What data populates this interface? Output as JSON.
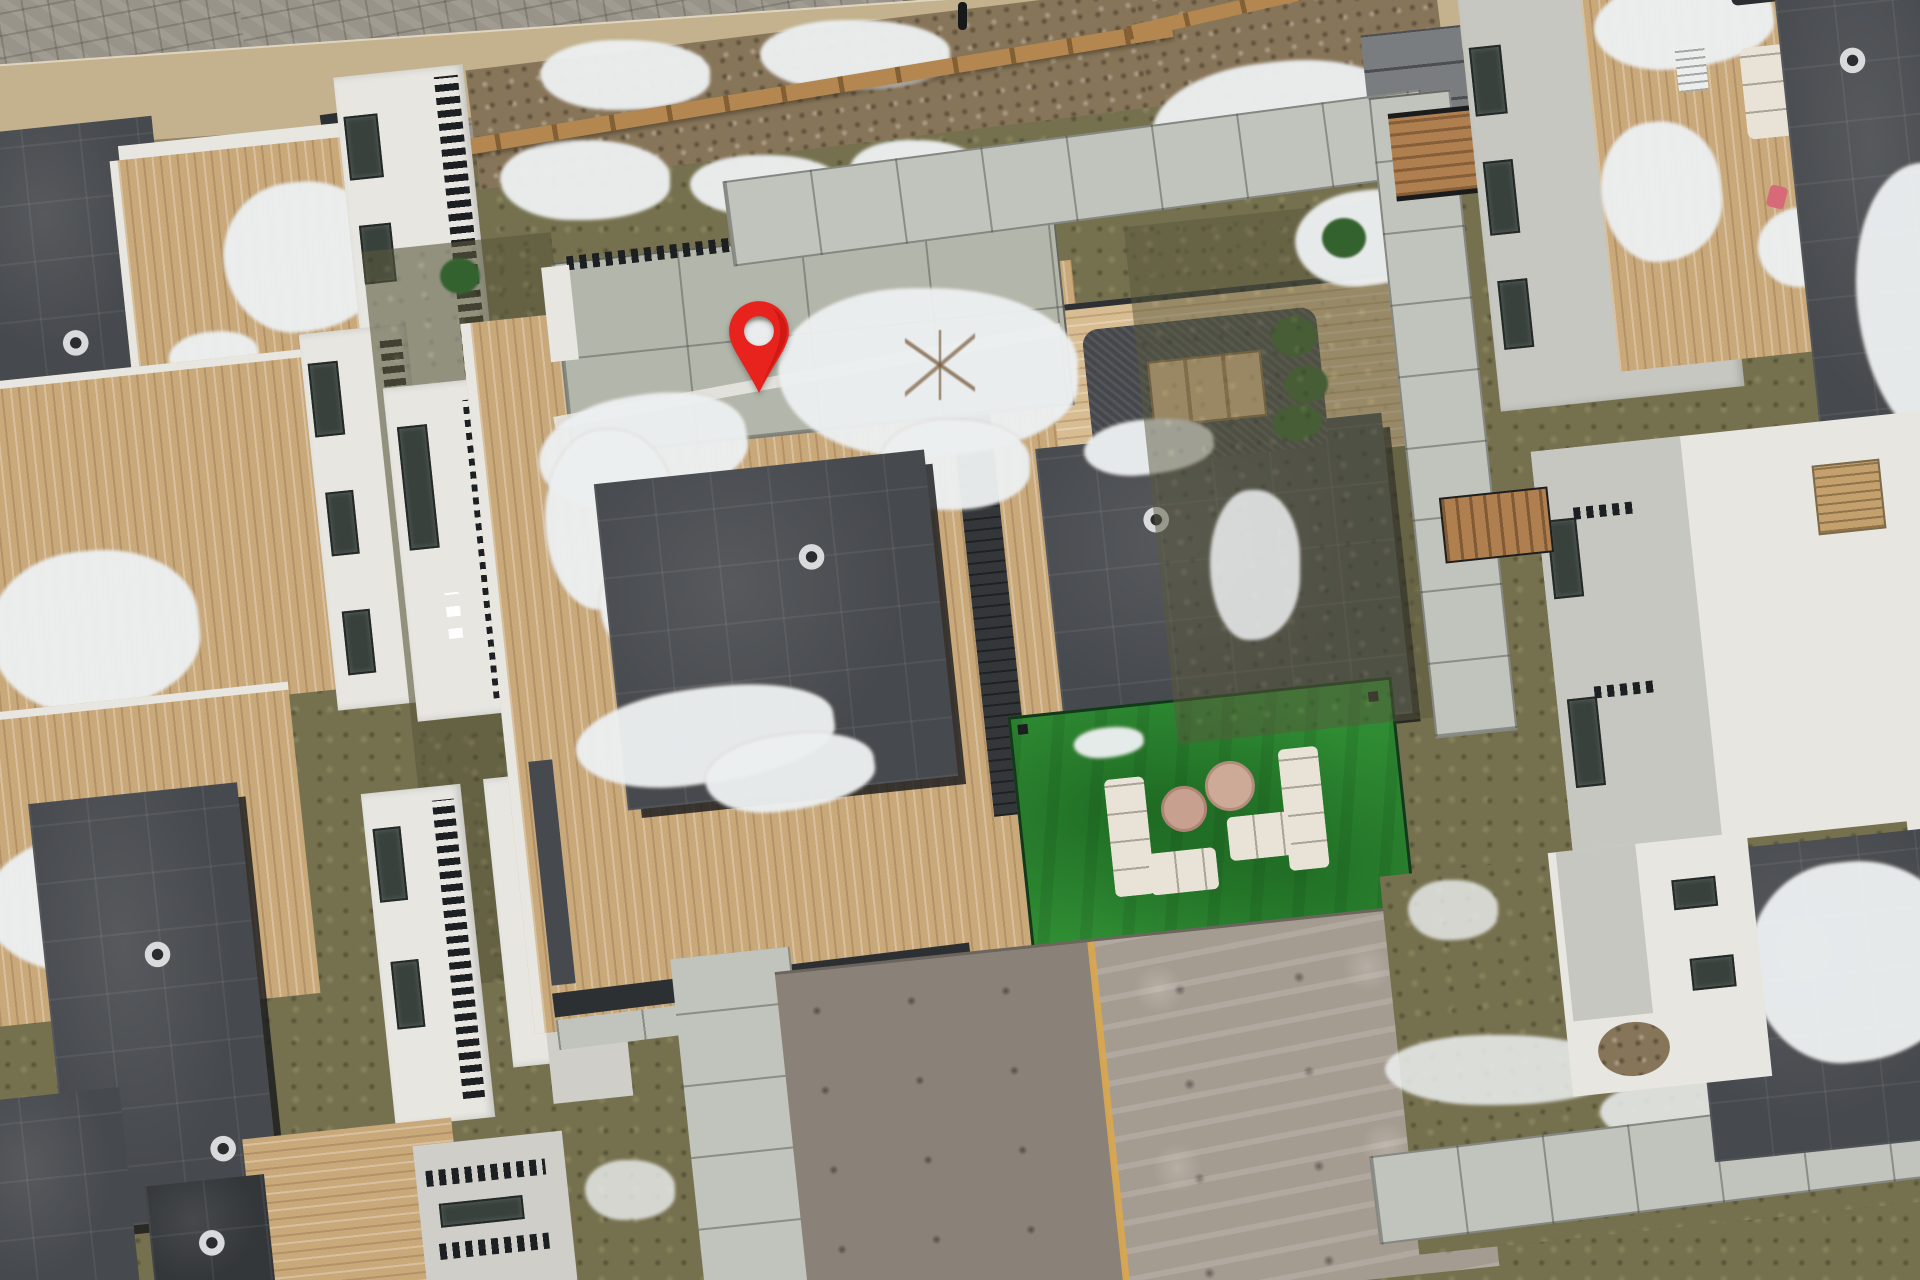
{
  "scene": {
    "type": "aerial-drone-photo",
    "subject": "winter aerial view of a modern townhome complex with rooftop wood decks, a courtyard turf patio and a highlighted property",
    "marker": {
      "icon": "map-pin-icon",
      "color": "#e8231e",
      "shade_color": "#b8130d"
    },
    "palette": {
      "grass_olive": "#75714f",
      "grass_dark": "#5b593e",
      "paver_gray": "#99948a",
      "tan_roof": "#c3b28d",
      "mulch_brown": "#87755a",
      "fence_wood": "#b3874f",
      "snow_white": "#edf0f1",
      "concrete": "#c1c4bd",
      "patio_slab": "#b3b7ab",
      "wood_deck": "#c9a87a",
      "wood_deck_pale": "#d9bd92",
      "roof_charcoal": "#46494d",
      "roof_dark": "#34373a",
      "gutter_dark": "#2d3033",
      "white_wall": "#e7e6e1",
      "white_dim": "#cfcec9",
      "window_dark": "#39413d",
      "turf_green": "#2f8c33",
      "sofa_cream": "#e8e3d6",
      "pouf_tan": "#c7a090",
      "pouf_tan2": "#cdaa97",
      "plant_green": "#33622e",
      "asphalt_left": "#8a8178",
      "asphalt_right": "#a49b91",
      "road_yellow": "#d8a851",
      "building_gray": "#c7c7c1",
      "steps_gray": "#7a7d80",
      "ramp_wood": "#b07f4f",
      "chair_tan": "#c4a06c",
      "tarp_dark": "#2c2e31",
      "toy_pink": "#d66a78",
      "table_wood": "#d9b88a",
      "wicker_dark": "#44474b"
    },
    "objects": [
      {
        "name": "map-pin",
        "note": "red location marker over rooftop deck"
      },
      {
        "name": "turf-lounge",
        "note": "green artificial turf with two white sectional sofas and two round poufs"
      },
      {
        "name": "outdoor-dining-set",
        "note": "wood table with dark wicker chairs on upper deck"
      },
      {
        "name": "townhome-roofs",
        "note": "flat charcoal roofs with round vents"
      },
      {
        "name": "wood-decks",
        "note": "tan plank rooftop decks with melting snow patches"
      },
      {
        "name": "road",
        "note": "asphalt lane with yellow center line at bottom"
      },
      {
        "name": "fence",
        "note": "wooden split-rail fence along top"
      },
      {
        "name": "walkways",
        "note": "concrete paver paths between buildings"
      }
    ]
  }
}
